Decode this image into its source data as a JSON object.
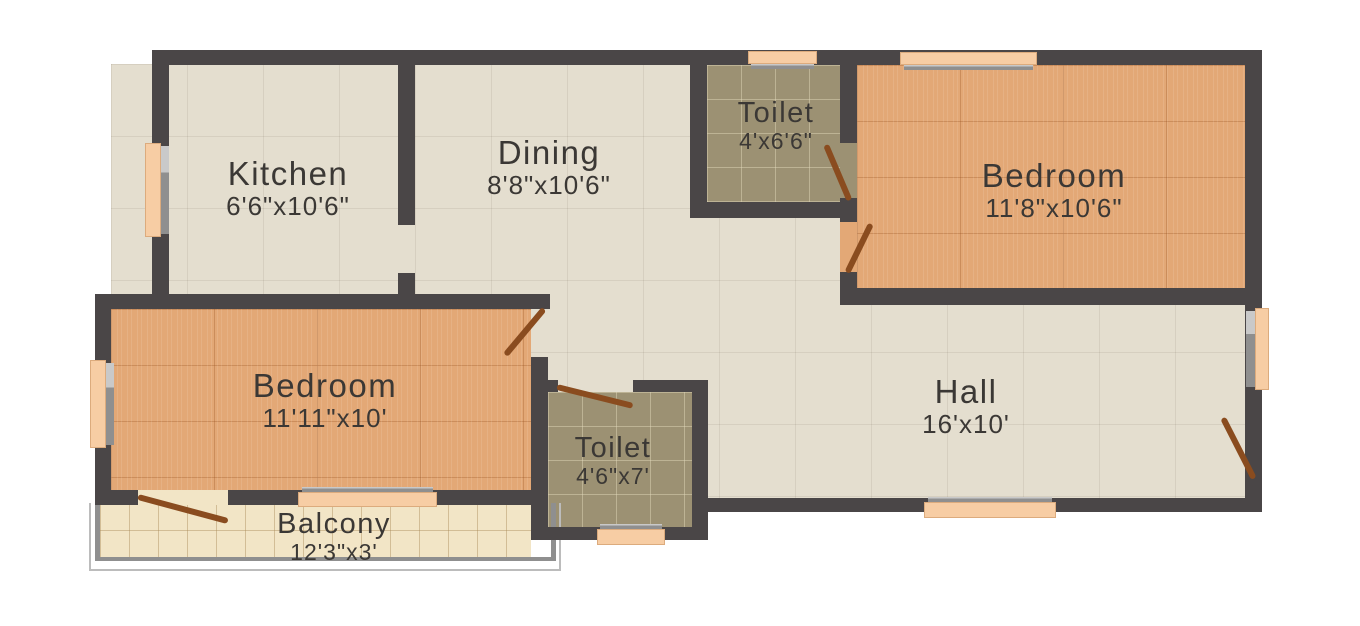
{
  "plan": {
    "rooms": {
      "kitchen": {
        "name": "Kitchen",
        "dims": "6'6\"x10'6\""
      },
      "dining": {
        "name": "Dining",
        "dims": "8'8\"x10'6\""
      },
      "toilet_top": {
        "name": "Toilet",
        "dims": "4'x6'6\""
      },
      "bedroom_right": {
        "name": "Bedroom",
        "dims": "11'8\"x10'6\""
      },
      "bedroom_left": {
        "name": "Bedroom",
        "dims": "11'11\"x10'"
      },
      "hall": {
        "name": "Hall",
        "dims": "16'x10'"
      },
      "toilet_bottom": {
        "name": "Toilet",
        "dims": "4'6\"x7'"
      },
      "balcony": {
        "name": "Balcony",
        "dims": "12'3\"x3'"
      }
    },
    "colors": {
      "background": "#ffffff",
      "wall": "#4a4647",
      "floor_tile": "#e4decf",
      "floor_wood": "#e3a876",
      "floor_toilet": "#9c9173",
      "floor_balcony": "#f2e5c6",
      "window": "#f7cda4",
      "door": "#8a4c1f",
      "label": "#3b3835"
    }
  }
}
